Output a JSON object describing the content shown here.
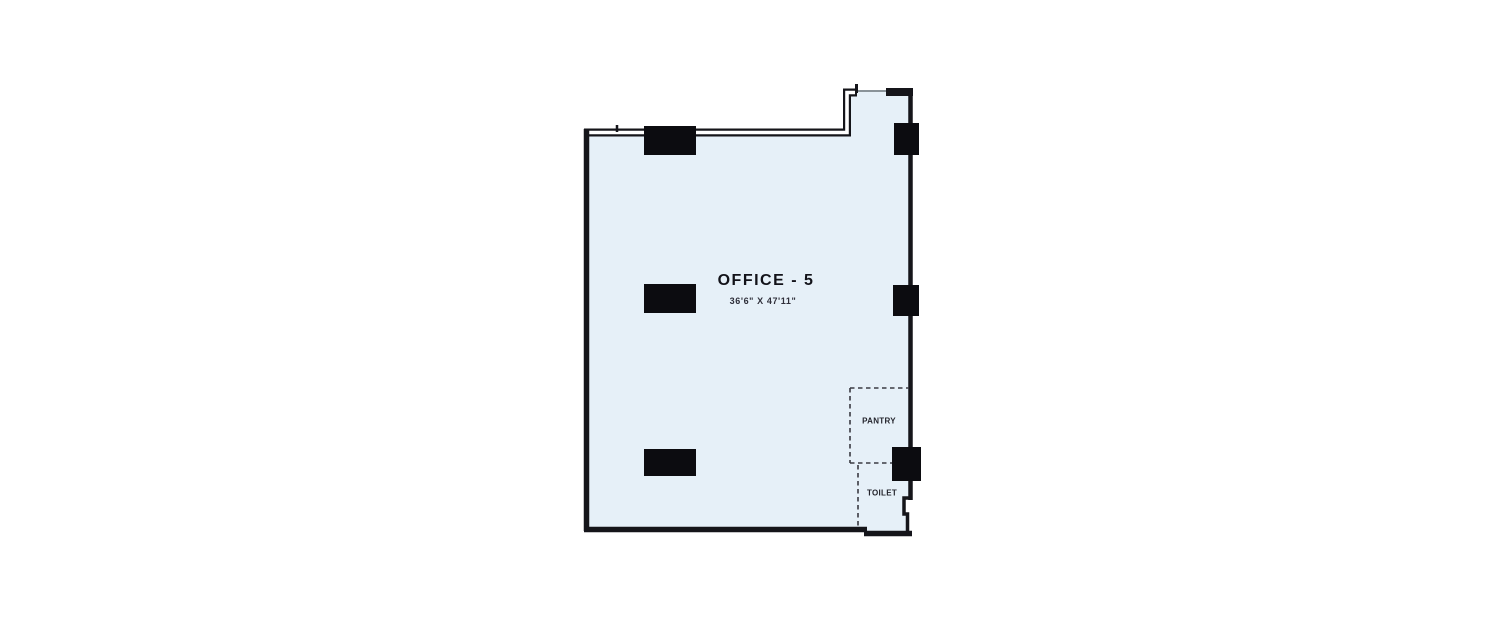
{
  "floor_plan": {
    "room": {
      "name": "OFFICE - 5",
      "dimensions": "36'6\" X 47'11\""
    },
    "sub_rooms": [
      {
        "name": "PANTRY"
      },
      {
        "name": "TOILET"
      }
    ],
    "colors": {
      "room_fill": "#e6f0f8",
      "wall": "#15151a",
      "column_fill": "#0c0c10",
      "dashed_line": "#3a3a42",
      "opening_line": "#8a9399",
      "background": "#ffffff"
    }
  }
}
